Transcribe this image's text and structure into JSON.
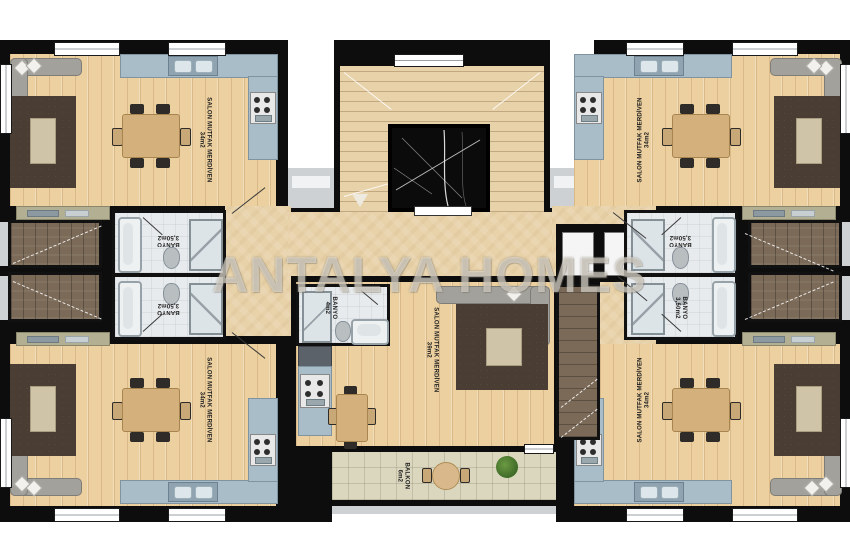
{
  "watermark": "ANTALYA HOMES",
  "colors": {
    "wall": "#0d0d0d",
    "wood_floor": "#ecd0a0",
    "stone_floor": "#e8d2a9",
    "bathroom_floor": "#e8ebed",
    "kitchen_counter": "#a9bdc9",
    "rug": "#4a3d33",
    "sofa": "#a2a19b",
    "duplex_stairs_wood": "#7b6a58",
    "balcony_tile": "#dbd7bf",
    "plant": "#4e7c32",
    "elevator": "#0b0b0b"
  },
  "units": {
    "top_left": {
      "salon": {
        "name": "SALON MUTFAK MERDİVEN",
        "area": "34m2"
      },
      "bathroom": {
        "name": "BANYO",
        "area": "3,50m2"
      }
    },
    "top_right": {
      "salon": {
        "name": "SALON MUTFAK MERDİVEN",
        "area": "34m2"
      },
      "bathroom": {
        "name": "BANYO",
        "area": "3,50m2"
      }
    },
    "bottom_left": {
      "salon": {
        "name": "SALON MUTFAK MERDİVEN",
        "area": "34m2"
      },
      "bathroom": {
        "name": "BANYO",
        "area": "3,50m2"
      }
    },
    "bottom_right": {
      "salon": {
        "name": "SALON MUTFAK MERDİVEN",
        "area": "34m2"
      },
      "bathroom": {
        "name": "BANYO",
        "area": "3,50m2"
      }
    },
    "bottom_middle": {
      "salon": {
        "name": "SALON MUTFAK MERDİVEN",
        "area": "39m2"
      },
      "bathroom": {
        "name": "BANYO",
        "area": "4m2"
      },
      "balcony": {
        "name": "BALKON",
        "area": "6m2"
      }
    }
  }
}
